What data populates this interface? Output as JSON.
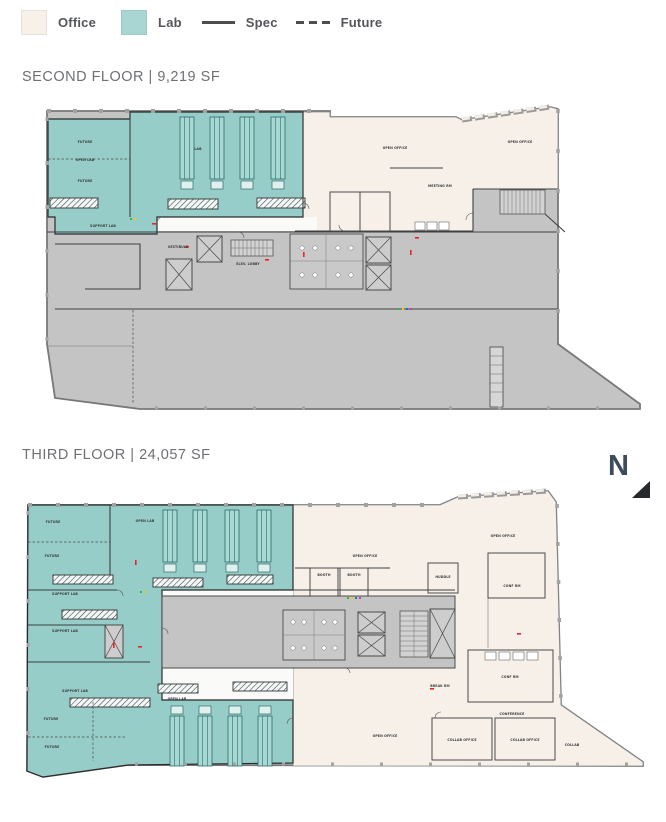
{
  "legend": {
    "items": [
      {
        "label": "Office",
        "type": "fill"
      },
      {
        "label": "Lab",
        "type": "fill"
      },
      {
        "label": "Spec",
        "type": "line-solid"
      },
      {
        "label": "Future",
        "type": "line-dashed"
      }
    ]
  },
  "colors": {
    "office": "#F7F1EA",
    "lab": "#A9D6D2",
    "plan_office": "#F6F0E9",
    "plan_lab": "#96CDC8",
    "plan_gray": "#C4C4C5",
    "legend_line": "#4E4E50",
    "accent_red": "#E8242A",
    "title_text": "#6E7073",
    "north_text": "#3D4C5A"
  },
  "north_label": "N",
  "floors": [
    {
      "id": "second",
      "title": "SECOND FLOOR | 9,219 SF",
      "plan_labels": [
        {
          "t": "FUTURE",
          "x": 50,
          "y": 46
        },
        {
          "t": "OPEN LAB",
          "x": 50,
          "y": 64
        },
        {
          "t": "FUTURE",
          "x": 50,
          "y": 85
        },
        {
          "t": "LAB",
          "x": 163,
          "y": 53
        },
        {
          "t": "SUPPORT LAB",
          "x": 68,
          "y": 130
        },
        {
          "t": "VESTIBULE",
          "x": 143,
          "y": 151
        },
        {
          "t": "ELEV. LOBBY",
          "x": 213,
          "y": 168
        },
        {
          "t": "OPEN OFFICE",
          "x": 360,
          "y": 52
        },
        {
          "t": "OPEN OFFICE",
          "x": 485,
          "y": 46
        },
        {
          "t": "MEETING RM",
          "x": 405,
          "y": 90
        }
      ]
    },
    {
      "id": "third",
      "title": "THIRD FLOOR | 24,057 SF",
      "plan_labels": [
        {
          "t": "FUTURE",
          "x": 38,
          "y": 45
        },
        {
          "t": "OPEN LAB",
          "x": 130,
          "y": 44
        },
        {
          "t": "FUTURE",
          "x": 37,
          "y": 79
        },
        {
          "t": "SUPPORT LAB",
          "x": 50,
          "y": 117
        },
        {
          "t": "SUPPORT LAB",
          "x": 50,
          "y": 154
        },
        {
          "t": "SUPPORT LAB",
          "x": 60,
          "y": 214
        },
        {
          "t": "OPEN LAB",
          "x": 162,
          "y": 222
        },
        {
          "t": "FUTURE",
          "x": 36,
          "y": 242
        },
        {
          "t": "FUTURE",
          "x": 37,
          "y": 270
        },
        {
          "t": "OPEN OFFICE",
          "x": 350,
          "y": 79
        },
        {
          "t": "OPEN OFFICE",
          "x": 488,
          "y": 59
        },
        {
          "t": "BOOTH",
          "x": 309,
          "y": 98
        },
        {
          "t": "BOOTH",
          "x": 339,
          "y": 98
        },
        {
          "t": "HUDDLE",
          "x": 428,
          "y": 100
        },
        {
          "t": "CONF RM",
          "x": 497,
          "y": 109
        },
        {
          "t": "BREAK RM",
          "x": 425,
          "y": 209
        },
        {
          "t": "CONF RM",
          "x": 495,
          "y": 200
        },
        {
          "t": "OPEN OFFICE",
          "x": 370,
          "y": 259
        },
        {
          "t": "CONFERENCE",
          "x": 497,
          "y": 237
        },
        {
          "t": "COLLAB OFFICE",
          "x": 447,
          "y": 263
        },
        {
          "t": "COLLAB OFFICE",
          "x": 510,
          "y": 263
        },
        {
          "t": "COLLAB",
          "x": 557,
          "y": 268
        }
      ]
    }
  ]
}
